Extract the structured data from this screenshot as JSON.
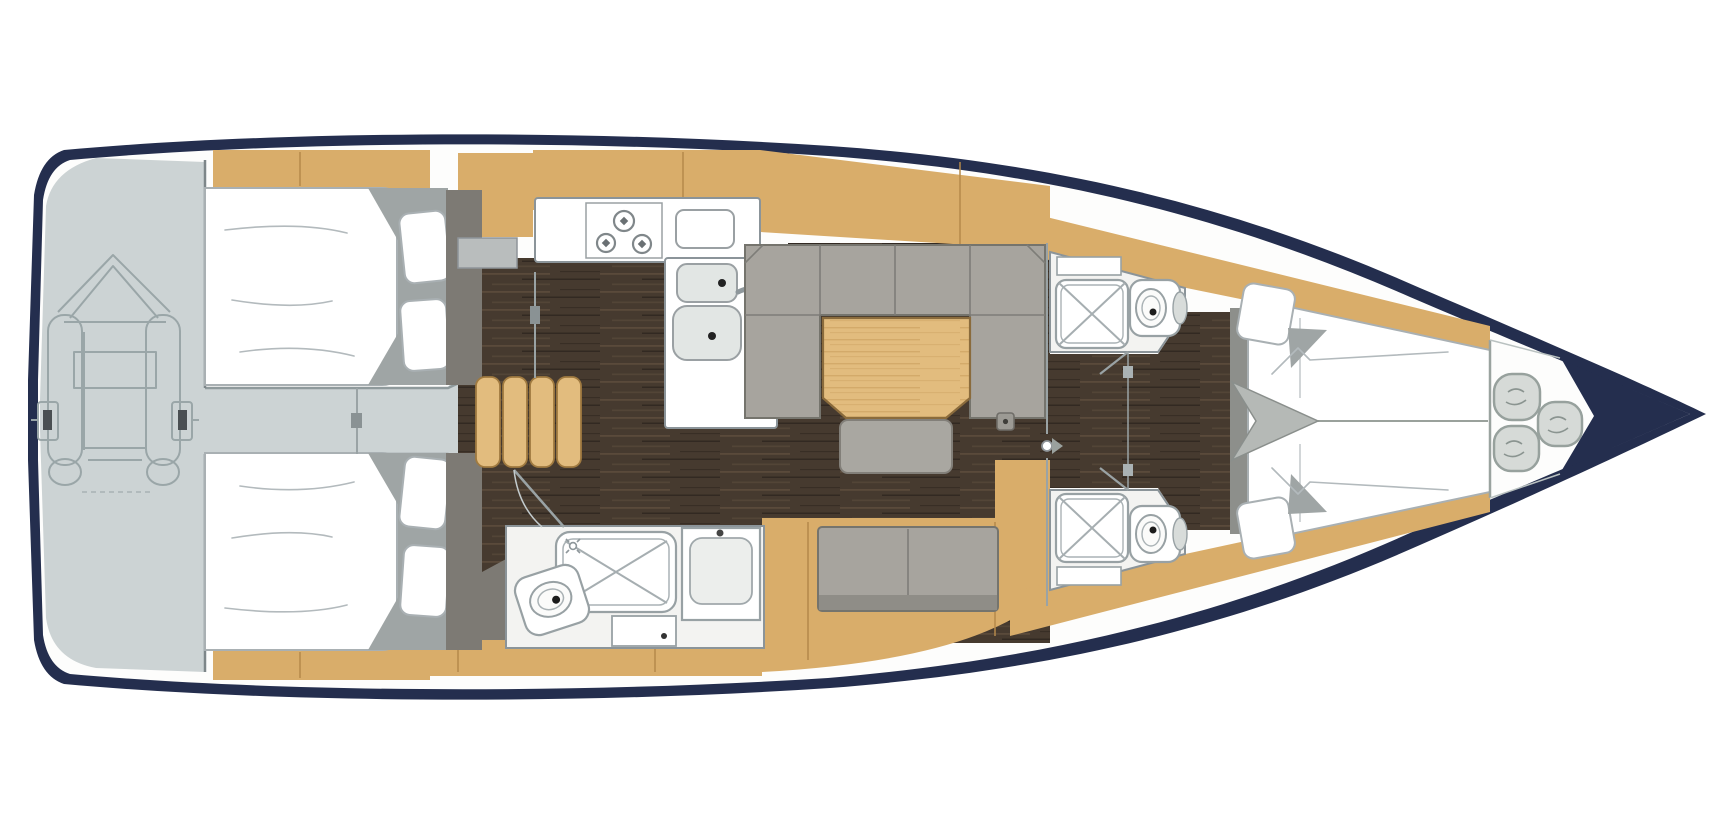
{
  "canvas": {
    "width": 1718,
    "height": 838,
    "background": "#ffffff"
  },
  "palette": {
    "hull_navy": "#242e4e",
    "paper_white": "#fdfdfc",
    "platform_gray": "#ccd3d4",
    "walkway_edge": "#8f9a9c",
    "teak": "#d9ad6a",
    "teak_light": "#e2bc7e",
    "teak_seam": "#b4884a",
    "walnut": "#463a2f",
    "walnut_streak": "#6a5845",
    "walnut_dark": "#2a221c",
    "settee_gray": "#a7a49e",
    "settee_seam": "#7e7d78",
    "settee_stroke": "#75746d",
    "fixture_white": "#ffffff",
    "head_floor": "#f3f3f1",
    "outline_gray": "#8b9499",
    "bed_outline": "#a9b0b3",
    "wardrobe_gray": "#7d7a74",
    "blanket_gray": "#9fa5a5",
    "foot_band": "#8d8f8b",
    "arrow_gray": "#b5b9b6",
    "coil_fill": "#d6dad7",
    "coil_stroke": "#97a19d",
    "dinghy_line": "#9aa6a8",
    "line_gray": "#9aa3a5",
    "sheet_line": "#b3babd",
    "basin_gray": "#e2e6e4",
    "drain_dark": "#222222"
  },
  "diagram": {
    "type": "yacht-interior-deck-plan",
    "orientation": "bow-right",
    "areas": [
      "swim-platform",
      "aft-cabin-port",
      "aft-cabin-starboard",
      "companionway",
      "galley",
      "salon",
      "aft-head",
      "fore-head-port",
      "fore-head-starboard",
      "fore-cabin-v-berth",
      "anchor-locker"
    ],
    "fixtures": [
      "tender-dinghy",
      "companionway-steps",
      "three-burner-stove",
      "double-sink",
      "sink-lid-counter",
      "dinette-table",
      "u-settee",
      "ottoman-bench",
      "two-seat-sofa",
      "shower-tray",
      "marine-toilet",
      "washbasin",
      "double-berth",
      "pillows",
      "v-berth",
      "mast-step",
      "mooring-line-coils"
    ]
  }
}
